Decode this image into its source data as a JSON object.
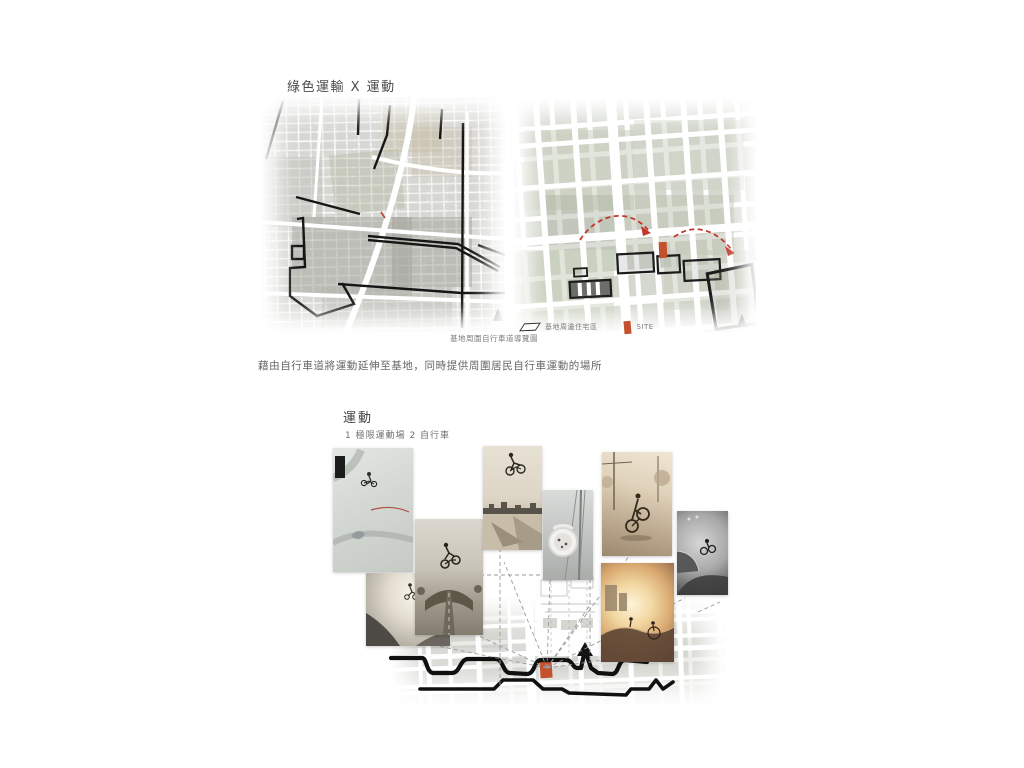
{
  "poster": {
    "section_green_transport": {
      "title": "綠色運輸 X 運動",
      "left_map": {
        "caption": "基地周圍自行車道導覽圖",
        "north_arrow": "north-arrow-icon"
      },
      "right_map": {
        "legend_residential": "基地周邊住宅區",
        "legend_site": "SITE",
        "north_arrow": "north-arrow-icon"
      },
      "description": "藉由自行車道將運動延伸至基地，同時提供周圍居民自行車運動的場所"
    },
    "section_sport": {
      "title": "運動",
      "subtitle": "1 極限運動場   2 自行車",
      "photos": [
        "aerial-skatepark-bmx-trick",
        "backlit-skatepark-jump",
        "bmx-dirt-jump-fisheye",
        "bmx-tailwhip-city-sky",
        "full-pipe-wheel-view",
        "bmx-street-nose-manual",
        "skatepark-bw-fisheye",
        "skatepark-sunset-bowl"
      ]
    },
    "colors": {
      "site_orange": "#c4512e",
      "route_black": "#141414",
      "arc_red": "#c0392b",
      "text_dark": "#3f3f3f",
      "text_gray": "#6e6e6e"
    }
  }
}
